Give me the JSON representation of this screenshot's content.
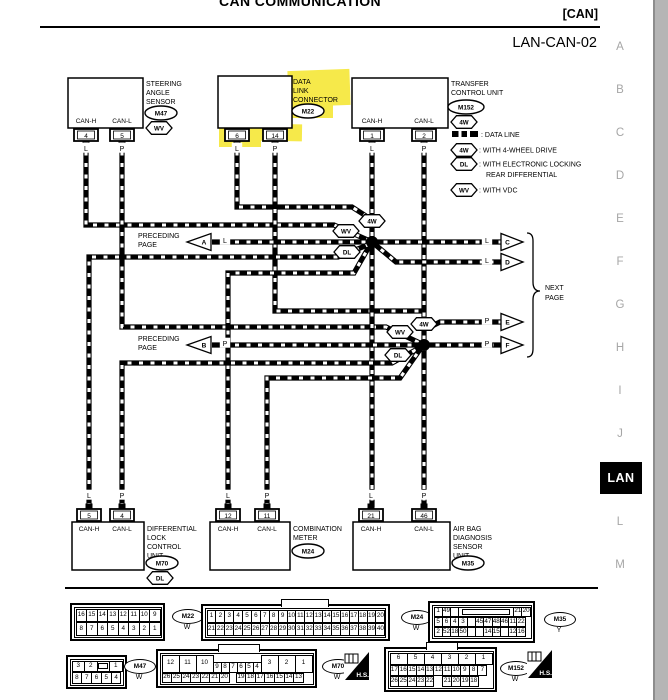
{
  "header": {
    "title": "CAN COMMUNICATION",
    "section_tag": "[CAN]",
    "page_id": "LAN-CAN-02"
  },
  "side_index": {
    "letters_above": [
      "A",
      "B",
      "C",
      "D",
      "E",
      "F",
      "G",
      "H",
      "I",
      "J"
    ],
    "active_tab": "LAN",
    "letters_below": [
      "L",
      "M"
    ]
  },
  "legend": {
    "data_line_label": ": DATA LINE",
    "items": [
      {
        "flag": "4W",
        "label": ": WITH 4-WHEEL DRIVE",
        "label2": ""
      },
      {
        "flag": "DL",
        "label": ": WITH ELECTRONIC LOCKING",
        "label2": "REAR DIFFERENTIAL"
      },
      {
        "flag": "WV",
        "label": ": WITH VDC",
        "label2": ""
      }
    ]
  },
  "arrows": {
    "preceding_label_1": "PRECEDING",
    "preceding_label_2": "PAGE",
    "next_label_1": "NEXT",
    "next_label_2": "PAGE",
    "to_preceding": [
      {
        "letter": "A",
        "wire": "L"
      },
      {
        "letter": "B",
        "wire": "P"
      }
    ],
    "to_next": [
      {
        "letter": "C",
        "wire": "L"
      },
      {
        "letter": "D",
        "wire": "L"
      },
      {
        "letter": "E",
        "wire": "P"
      },
      {
        "letter": "F",
        "wire": "P"
      }
    ]
  },
  "wire_flags": [
    "4W",
    "WV",
    "DL",
    "4W",
    "WV",
    "DL"
  ],
  "components": {
    "top": [
      {
        "name_lines": [
          "STEERING",
          "ANGLE",
          "SENSOR"
        ],
        "ref": "M47",
        "flag": "WV",
        "highlighted": false,
        "pins": [
          {
            "pin_label": "CAN-H",
            "pin": "4",
            "wire": "L"
          },
          {
            "pin_label": "CAN-L",
            "pin": "5",
            "wire": "P"
          }
        ]
      },
      {
        "name_lines": [
          "DATA",
          "LINK",
          "CONNECTOR"
        ],
        "ref": "M22",
        "flag": "",
        "highlighted": true,
        "pins": [
          {
            "pin_label": "",
            "pin": "6",
            "wire": "L"
          },
          {
            "pin_label": "",
            "pin": "14",
            "wire": "P"
          }
        ]
      },
      {
        "name_lines": [
          "TRANSFER",
          "CONTROL UNIT"
        ],
        "ref": "M152",
        "flag": "4W",
        "highlighted": false,
        "pins": [
          {
            "pin_label": "CAN-H",
            "pin": "1",
            "wire": "L"
          },
          {
            "pin_label": "CAN-L",
            "pin": "2",
            "wire": "P"
          }
        ]
      }
    ],
    "bottom": [
      {
        "name_lines": [
          "DIFFERENTIAL",
          "LOCK",
          "CONTROL",
          "UNIT"
        ],
        "ref": "M70",
        "flag": "DL",
        "pins": [
          {
            "pin_label": "CAN-H",
            "pin": "5",
            "wire": "L"
          },
          {
            "pin_label": "CAN-L",
            "pin": "4",
            "wire": "P"
          }
        ]
      },
      {
        "name_lines": [
          "COMBINATION",
          "METER"
        ],
        "ref": "M24",
        "flag": "",
        "pins": [
          {
            "pin_label": "CAN-H",
            "pin": "12",
            "wire": "L"
          },
          {
            "pin_label": "CAN-L",
            "pin": "11",
            "wire": "P"
          }
        ]
      },
      {
        "name_lines": [
          "AIR BAG",
          "DIAGNOSIS",
          "SENSOR",
          "UNIT"
        ],
        "ref": "M35",
        "flag": "",
        "pins": [
          {
            "pin_label": "CAN-H",
            "pin": "21",
            "wire": "L"
          },
          {
            "pin_label": "CAN-L",
            "pin": "46",
            "wire": "P"
          }
        ]
      }
    ]
  },
  "connector_views": [
    {
      "ref": "M22",
      "color": "W",
      "rows": [
        [
          "16",
          "15",
          "14",
          "13",
          "12",
          "11",
          "10",
          "9"
        ],
        [
          "8",
          "7",
          "6",
          "5",
          "4",
          "3",
          "2",
          "1"
        ]
      ]
    },
    {
      "ref": "M24",
      "color": "W",
      "rows": [
        [
          "1",
          "2",
          "3",
          "4",
          "5",
          "6",
          "7",
          "8",
          "9",
          "10",
          "11",
          "12",
          "13",
          "14",
          "15",
          "16",
          "17",
          "18",
          "19",
          "20"
        ],
        [
          "21",
          "22",
          "23",
          "24",
          "25",
          "26",
          "27",
          "28",
          "29",
          "30",
          "31",
          "32",
          "33",
          "34",
          "35",
          "36",
          "37",
          "38",
          "39",
          "40"
        ]
      ]
    },
    {
      "ref": "M35",
      "color": "Y",
      "rows": [
        [
          "1",
          "49",
          "",
          "—",
          "21",
          "20"
        ],
        [
          "5",
          "6",
          "4",
          "3",
          "",
          "45",
          "47",
          "48",
          "46",
          "11",
          "22"
        ],
        [
          "2",
          "52",
          "18",
          "50",
          "",
          "",
          "14",
          "15",
          "",
          "12",
          "16"
        ]
      ]
    },
    {
      "ref": "M47",
      "color": "W",
      "rows": [
        [
          "3",
          "2",
          "—",
          "1"
        ],
        [
          "8",
          "7",
          "6",
          "5",
          "4"
        ]
      ]
    },
    {
      "ref": "M70",
      "color": "W",
      "hs": true,
      "rows": [
        [
          "12",
          "11",
          "10",
          "9",
          "8",
          "7",
          "6",
          "5",
          "4",
          "3",
          "2",
          "1"
        ],
        [
          "26",
          "25",
          "24",
          "23",
          "22",
          "21",
          "20",
          "19",
          "18",
          "17",
          "16",
          "15",
          "14",
          "13"
        ]
      ]
    },
    {
      "ref": "M152",
      "color": "W",
      "hs": true,
      "rows": [
        [
          "6",
          "5",
          "4",
          "3",
          "2",
          "1"
        ],
        [
          "17",
          "16",
          "15",
          "14",
          "13",
          "12",
          "11",
          "10",
          "9",
          "8",
          "7"
        ],
        [
          "26",
          "25",
          "24",
          "23",
          "22",
          "21",
          "20",
          "19",
          "18"
        ]
      ]
    }
  ],
  "hs_label": "H.S.",
  "colors": {
    "highlight": "#f6e94a",
    "ink": "#000000",
    "paper": "#ffffff",
    "margin_gray": "#a6a6a6",
    "tab_bg": "#000000",
    "tab_fg": "#ffffff",
    "scroll_strip": "#b5b5b5"
  }
}
